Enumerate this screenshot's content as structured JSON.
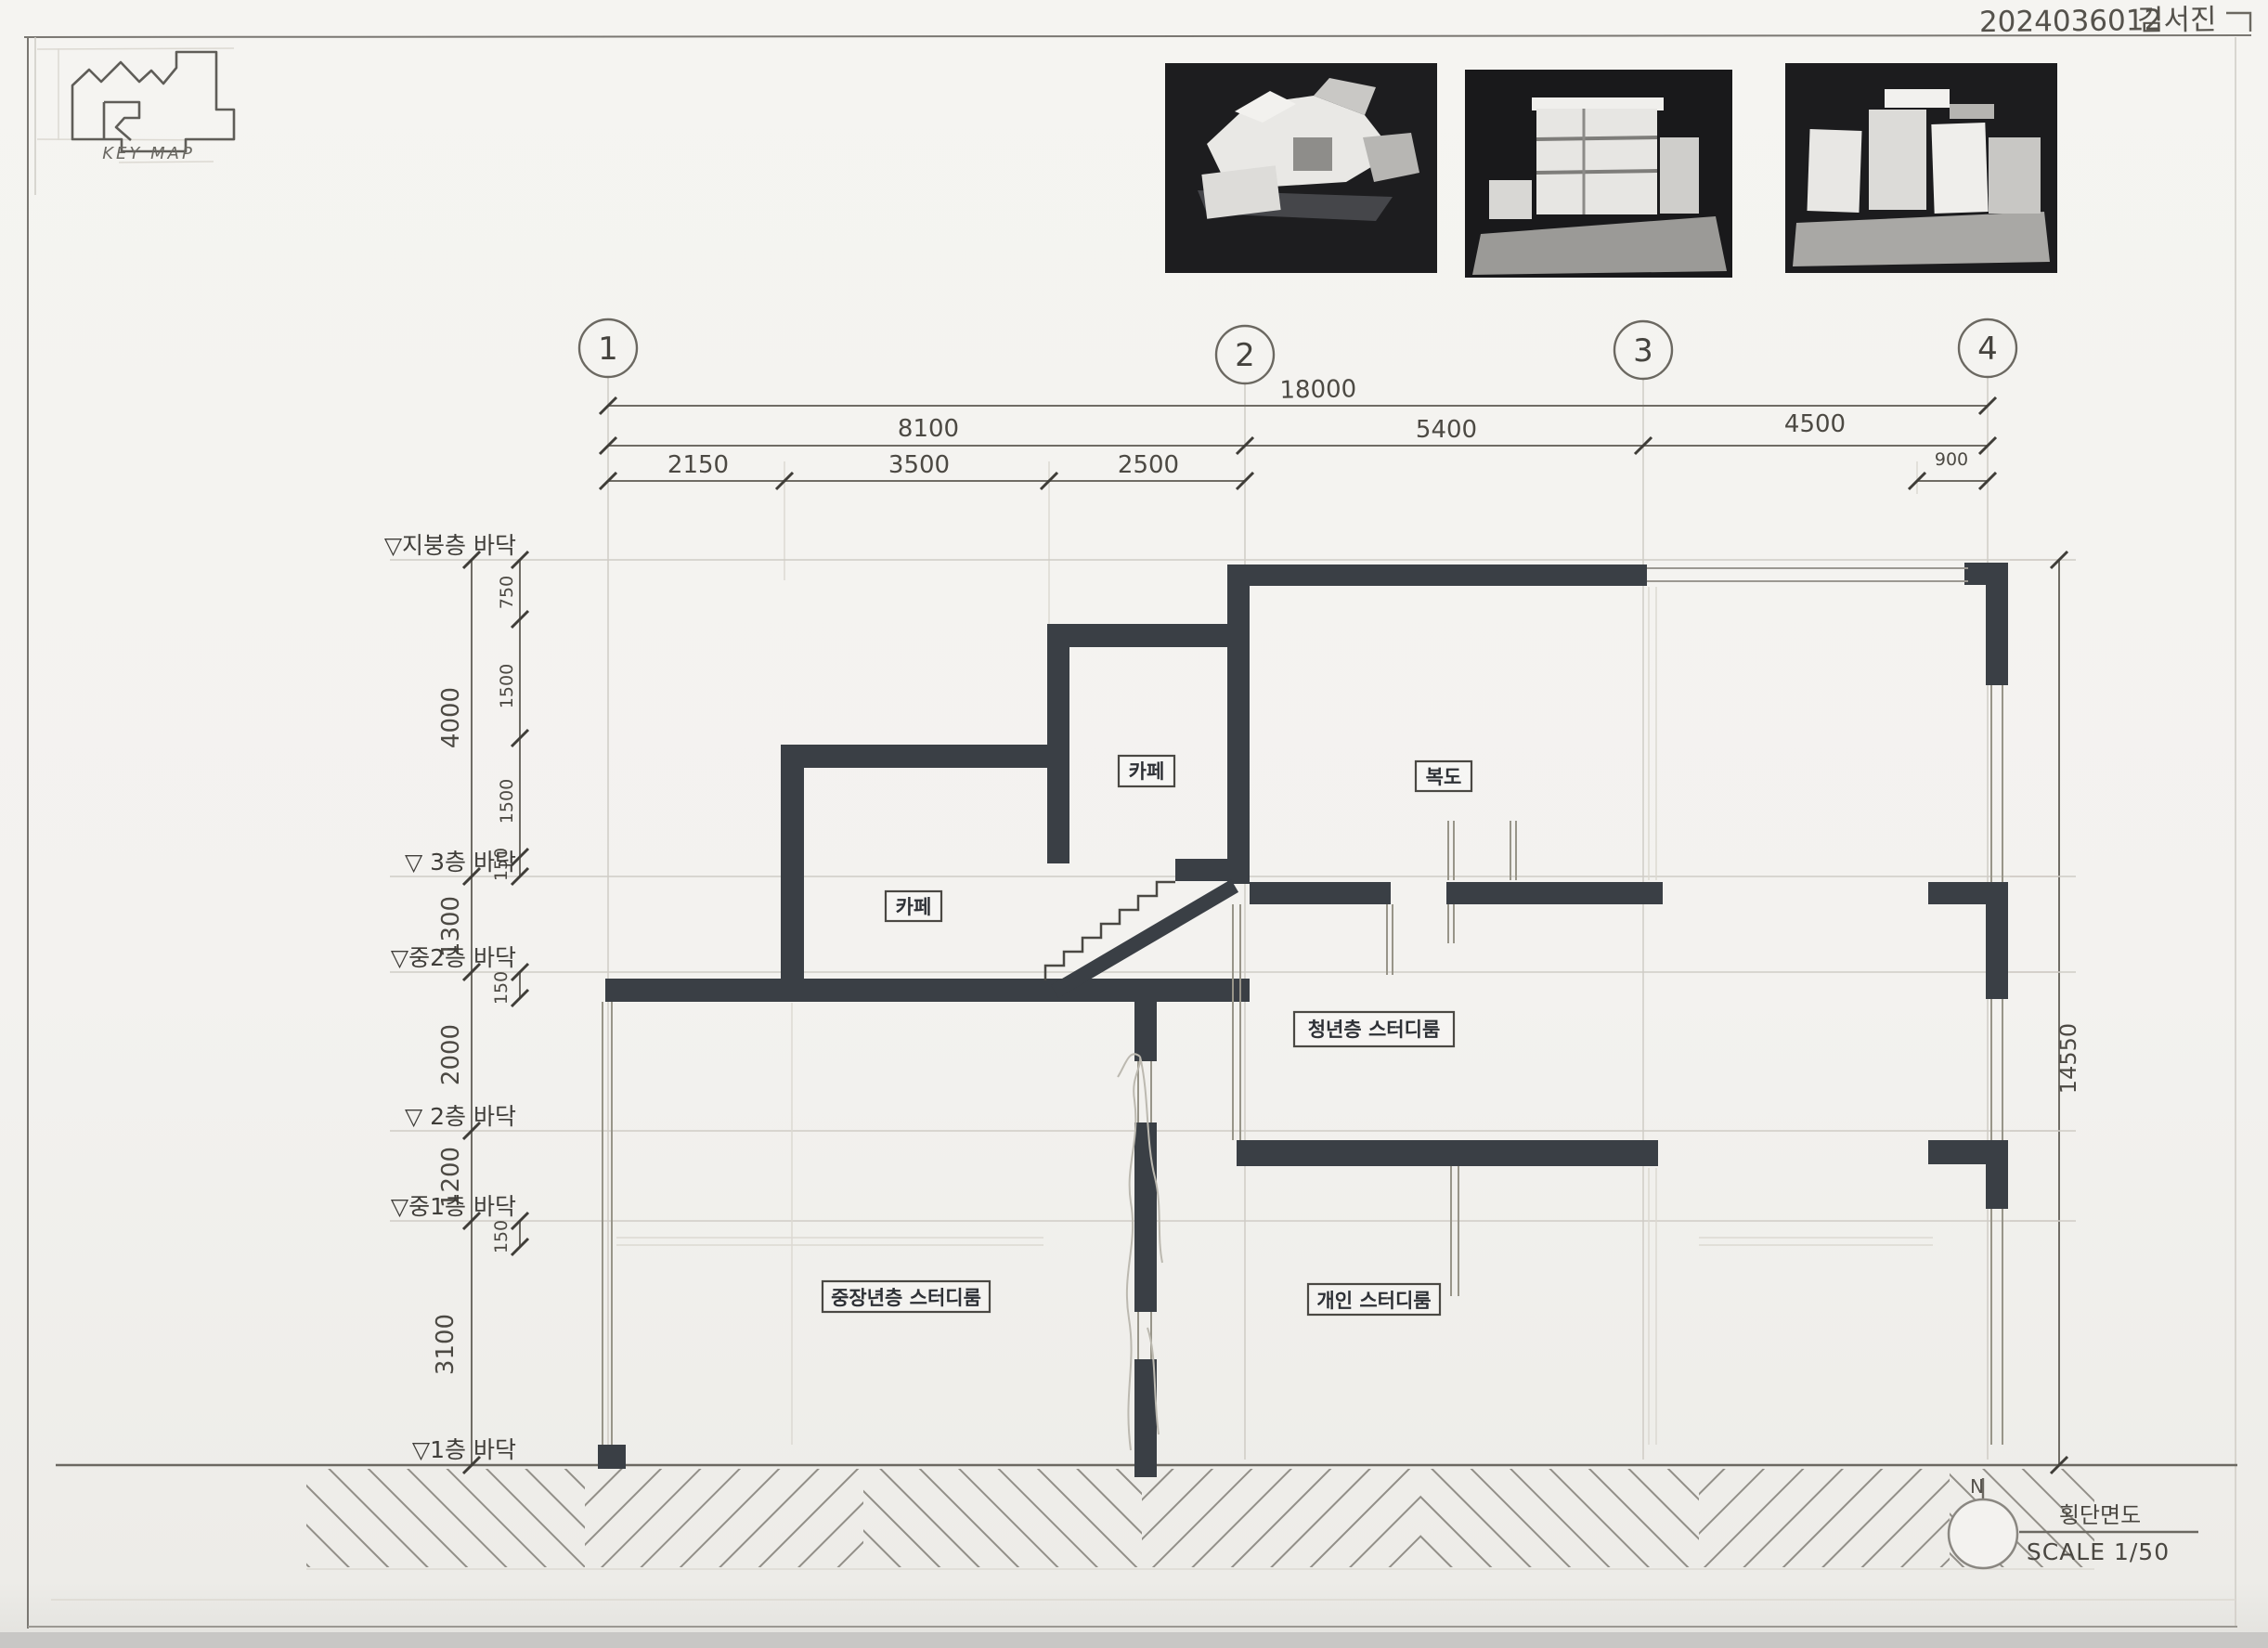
{
  "header": {
    "student_id": "2024036012",
    "student_name": "김서진",
    "key_map_label": "KEY MAP"
  },
  "grid_bubbles": [
    "1",
    "2",
    "3",
    "4"
  ],
  "dimensions": {
    "top_total": "18000",
    "top_spans": [
      "8100",
      "5400",
      "4500"
    ],
    "top_subspans": [
      "2150",
      "3500",
      "2500"
    ],
    "top_right_small": "900",
    "left_major": [
      "4000",
      "1300",
      "2000",
      "1200",
      "3100"
    ],
    "left_minor": [
      "750",
      "1500",
      "1500",
      "150",
      "150",
      "150"
    ],
    "right_total": "14550"
  },
  "levels": [
    "▽지붕층 바닥",
    "▽ 3층 바닥",
    "▽중2층 바닥",
    "▽ 2층 바닥",
    "▽중1층 바닥",
    "▽1층 바닥"
  ],
  "rooms": [
    "카페",
    "복도",
    "카페",
    "청년층 스터디룸",
    "중장년층 스터디룸",
    "개인 스터디룸"
  ],
  "title_block": {
    "north_label": "N",
    "drawing_title": "횡단면도",
    "scale_label": "SCALE 1/50"
  }
}
